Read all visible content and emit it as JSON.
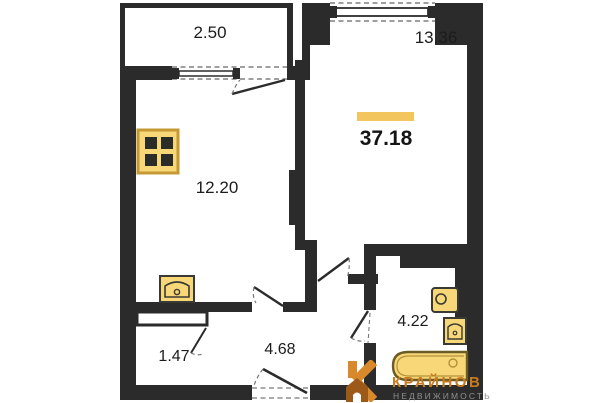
{
  "floorplan": {
    "total_area": "37.18",
    "rooms": [
      {
        "id": "balcony",
        "area": "2.50"
      },
      {
        "id": "living-room",
        "area": "13.36"
      },
      {
        "id": "room",
        "area": "12.20"
      },
      {
        "id": "storage",
        "area": "1.47"
      },
      {
        "id": "hallway",
        "area": "4.68"
      },
      {
        "id": "bathroom",
        "area": "4.22"
      }
    ],
    "fixtures": [
      "stove-icon",
      "kitchen-sink-icon",
      "washing-machine-icon",
      "bathroom-sink-icon",
      "bathtub-icon"
    ]
  },
  "logo": {
    "name": "КРАЙНОВ",
    "tagline": "НЕДВИЖИМОСТЬ"
  },
  "colors": {
    "wall": "#2b2b2b",
    "fixture_fill": "#f8d778",
    "fixture_border": "#6b5b25",
    "stove_border": "#c59a35",
    "accent_bar": "#f2c55f",
    "logo_orange": "#c9791e",
    "logo_gray": "#8f8f8f",
    "label_color": "#1c1c1c"
  }
}
